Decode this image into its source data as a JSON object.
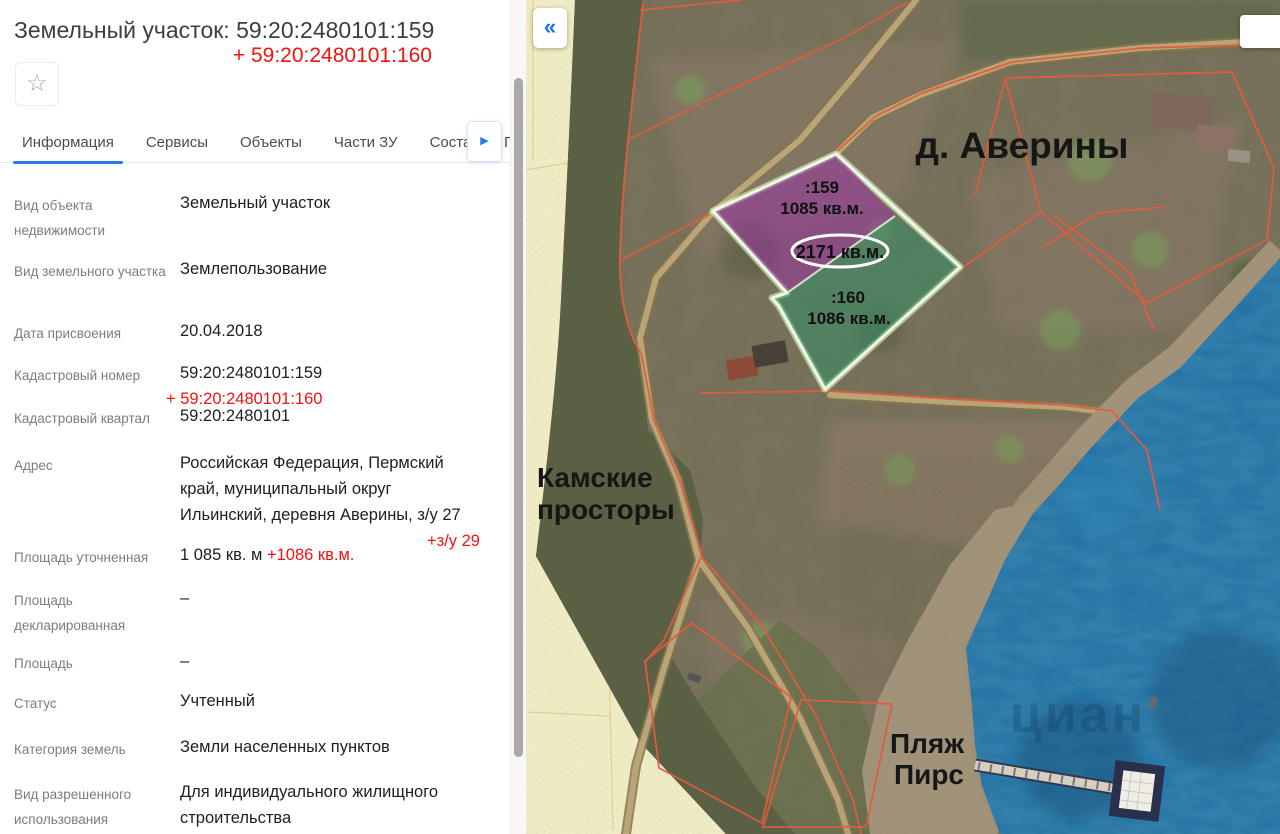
{
  "panel": {
    "title": "Земельный участок: 59:20:2480101:159",
    "title_addition": "+ 59:20:2480101:160",
    "star_icon": "☆",
    "tabs": [
      "Информация",
      "Сервисы",
      "Объекты",
      "Части ЗУ",
      "Соста",
      "Г"
    ],
    "active_tab": "Информация",
    "tabs_more_icon": "▶",
    "rows": [
      {
        "label": "Вид объекта недвижимости",
        "value": "Земельный участок"
      },
      {
        "label": "Вид земельного участка",
        "value": "Землепользование"
      },
      {
        "label": "Дата присвоения",
        "value": "20.04.2018"
      },
      {
        "label": "Кадастровый номер",
        "value": "59:20:2480101:159",
        "addition": "+ 59:20:2480101:160"
      },
      {
        "label": "Кадастровый квартал",
        "value": "59:20:2480101"
      },
      {
        "label": "Адрес",
        "value": "Российская Федерация, Пермский край, муниципальный округ Ильинский, деревня Аверины, з/у 27",
        "addition": "+з/у 29"
      },
      {
        "label": "Площадь уточненная",
        "value": "1 085 кв. м ",
        "addition": "+1086 кв.м."
      },
      {
        "label": "Площадь декларированная",
        "value": "–"
      },
      {
        "label": "Площадь",
        "value": "–"
      },
      {
        "label": "Статус",
        "value": "Учтенный"
      },
      {
        "label": "Категория земель",
        "value": "Земли населенных пунктов"
      },
      {
        "label": "Вид разрешенного использования",
        "value": "Для индивидуального жилищного строительства"
      }
    ]
  },
  "map": {
    "collapse_icon": "«",
    "village_label": "д. Аверины",
    "parcel159_id": ":159",
    "parcel159_area": "1085 кв.м.",
    "parcel160_id": ":160",
    "parcel160_area": "1086 кв.м.",
    "total_area": "2171 кв.м.",
    "place_line1": "Камские",
    "place_line2": "просторы",
    "beach_label": "Пляж",
    "pier_label": "Пирс",
    "watermark": "циан"
  },
  "colors": {
    "accent_blue": "#2b7ae9",
    "addition_red": "#f2120e",
    "parcel_purple": "#9a2fa5",
    "parcel_green": "#2f8f68",
    "parcel_outline": "#eefbe2",
    "cadastral_line": "#e45b3e",
    "water": "#1d6ba1",
    "zone_yellow": "#f9f4cc"
  }
}
